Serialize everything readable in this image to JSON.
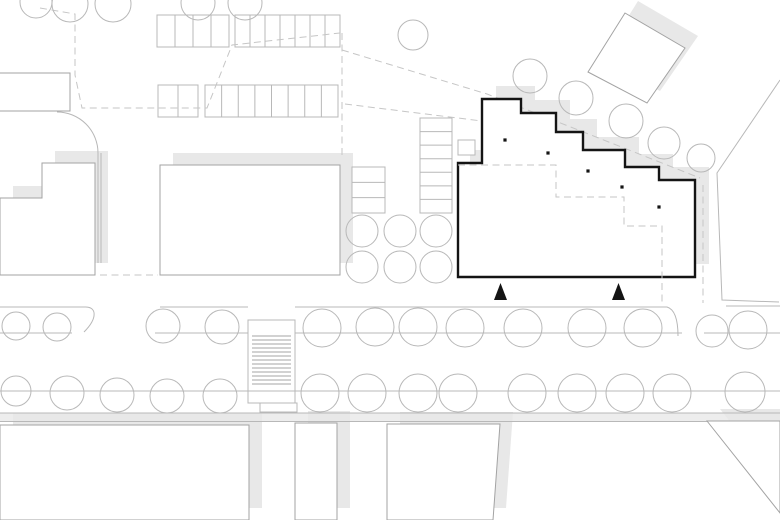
{
  "document": {
    "kind": "architectural-site-plan",
    "width": 780,
    "height": 520
  },
  "colors": {
    "background": "#ffffff",
    "line_thin": "#b8b8b8",
    "line_mid": "#a3a3a3",
    "line_dash": "#c6c6c6",
    "shadow": "#e8e8e8",
    "road": "#ededed",
    "ink": "#141414"
  },
  "plan": {
    "shadow_offset": {
      "dx": 13,
      "dy": -12
    },
    "road_band": {
      "x": 0,
      "y": 413,
      "w": 780,
      "h": 8.5
    },
    "gray_patches": [
      [
        0,
        86,
        13,
        25
      ],
      [
        470,
        152,
        8,
        11
      ]
    ],
    "street_lines": [
      "M0,307 H84 C97,306 98,318 84,332",
      "M0,333 H72",
      "M160,307 H248",
      "M155,333 H248",
      "M295,307 H667 C674,309 678,318 678,336",
      "M295,333 H682",
      "M726,306 H780",
      "M704,333 H780",
      "M0,391 H780",
      "M0,413 H780",
      "M0,421.5 H707",
      "M780,80 L717,173 L722,300 L779,302",
      "M57,112 A41,41 0 0 1 98,153 L98,263",
      "M101,153 V263"
    ],
    "dashed_lines": [
      "M40,8 L75,14 V75 L82,108 H207 L232,45 L340,33",
      "M342,33 V155",
      "M342,50 L487,94 L700,178",
      "M703,185 V303",
      "M100,275 H158",
      "M345,104 L482,121"
    ],
    "parking": [
      {
        "x": 157,
        "y": 15,
        "w": 72,
        "h": 32,
        "stalls": 4,
        "dir": "v"
      },
      {
        "x": 235,
        "y": 15,
        "w": 105,
        "h": 32,
        "stalls": 7,
        "dir": "v"
      },
      {
        "x": 158,
        "y": 85,
        "w": 40,
        "h": 32,
        "stalls": 2,
        "dir": "v"
      },
      {
        "x": 205,
        "y": 85,
        "w": 133,
        "h": 32,
        "stalls": 8,
        "dir": "v"
      },
      {
        "x": 420,
        "y": 118,
        "w": 32,
        "h": 95,
        "stalls": 7,
        "dir": "h"
      },
      {
        "x": 352,
        "y": 167,
        "w": 33,
        "h": 46,
        "stalls": 3,
        "dir": "h"
      }
    ],
    "trees": [
      [
        36,
        2,
        16
      ],
      [
        70,
        4,
        18
      ],
      [
        113,
        4,
        18
      ],
      [
        198,
        3,
        17
      ],
      [
        245,
        3,
        17
      ],
      [
        413,
        35,
        15
      ],
      [
        530,
        76,
        17
      ],
      [
        576,
        98,
        17
      ],
      [
        626,
        121,
        17
      ],
      [
        664,
        143,
        16
      ],
      [
        701,
        158,
        14
      ],
      [
        362,
        231,
        16
      ],
      [
        400,
        231,
        16
      ],
      [
        436,
        231,
        16
      ],
      [
        362,
        267,
        16
      ],
      [
        400,
        267,
        16
      ],
      [
        436,
        267,
        16
      ],
      [
        16,
        326,
        14
      ],
      [
        57,
        327,
        14
      ],
      [
        163,
        326,
        17
      ],
      [
        222,
        327,
        17
      ],
      [
        322,
        328,
        19
      ],
      [
        375,
        327,
        19
      ],
      [
        418,
        327,
        19
      ],
      [
        465,
        328,
        19
      ],
      [
        523,
        328,
        19
      ],
      [
        587,
        328,
        19
      ],
      [
        643,
        328,
        19
      ],
      [
        712,
        331,
        16
      ],
      [
        748,
        330,
        19
      ],
      [
        16,
        391,
        15
      ],
      [
        67,
        393,
        17
      ],
      [
        117,
        395,
        17
      ],
      [
        167,
        396,
        17
      ],
      [
        220,
        396,
        17
      ],
      [
        320,
        393,
        19
      ],
      [
        367,
        393,
        19
      ],
      [
        418,
        393,
        19
      ],
      [
        458,
        393,
        19
      ],
      [
        527,
        393,
        19
      ],
      [
        577,
        393,
        19
      ],
      [
        625,
        393,
        19
      ],
      [
        672,
        393,
        19
      ],
      [
        745,
        392,
        20
      ]
    ],
    "buildings": [
      {
        "name": "building-left",
        "d": "M0,198 H42 V163 H95 V275 H0 Z",
        "shadow": true
      },
      {
        "name": "building-middle",
        "d": "M160,165 H340 V275 H160 Z",
        "shadow": true
      },
      {
        "name": "corner-block",
        "d": "M0,73 H70 V111 H0",
        "shadow": false
      },
      {
        "name": "plaza-block",
        "d": "M0,425 H249 V520 H0 Z",
        "shadow": true
      },
      {
        "name": "building-south-narrow",
        "d": "M295,423 H337 V520 H295 Z",
        "shadow": true
      },
      {
        "name": "building-south",
        "d": "M387,424 H500 L493,520 H387 Z",
        "shadow": true
      },
      {
        "name": "block-southeast",
        "d": "M707,421 L780,513 V421 Z",
        "shadow": true
      }
    ],
    "rotated_building": {
      "d": "M588,72 L625,13 L685,48 L647,103 Z",
      "shadow": true
    },
    "crosswalk": {
      "x": 248,
      "y": 320,
      "w": 47,
      "h": 83,
      "stripe_y0": 336,
      "stripe_y1": 384,
      "stripe_count": 13,
      "stub": [
        260,
        403,
        37,
        9
      ]
    },
    "main_building": {
      "outline": "M482,99 H521 V113 H556 V132 H583 V150 H625 V167 H659 V180 H695 V277 H458 V163 H482 Z",
      "stroke_width": 2.4,
      "shadow_dx": 14,
      "shadow_dy": -13,
      "entry_canopy": {
        "x": 458,
        "y": 140,
        "w": 17,
        "h": 15
      },
      "columns": [
        [
          505,
          140
        ],
        [
          548,
          153
        ],
        [
          588,
          171
        ],
        [
          622,
          187
        ],
        [
          659,
          207
        ]
      ],
      "interior_dashed": [
        "M458,165 H556 V197 H624 V226 H662 V305"
      ],
      "entrance_markers": [
        {
          "cx": 500.5,
          "apex_y": 283,
          "base_y": 300,
          "half_w": 6.5
        },
        {
          "cx": 618.5,
          "apex_y": 283,
          "base_y": 300,
          "half_w": 6.5
        }
      ]
    }
  }
}
